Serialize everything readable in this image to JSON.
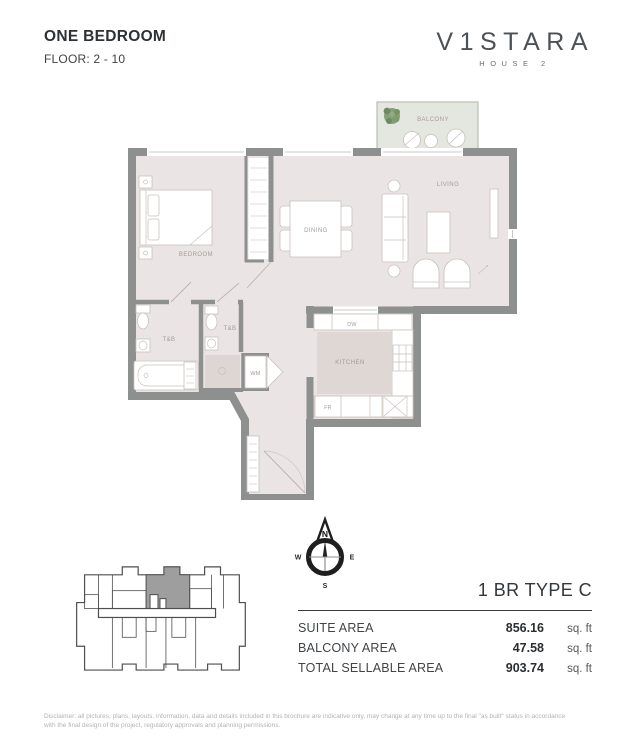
{
  "page": {
    "title": "ONE BEDROOM",
    "subtitle": "FLOOR: 2 - 10"
  },
  "logo": {
    "brand": "V1STARA",
    "sub_brand": "HOUSE 2"
  },
  "floorplan": {
    "labels": {
      "balcony": "BALCONY",
      "living": "LIVING",
      "dining": "DINING",
      "bedroom": "BEDROOM",
      "kitchen": "KITCHEN",
      "bath_main": "T&B",
      "bath_second": "T&B",
      "washer": "WM",
      "dishwasher": "DW",
      "fridge": "FR"
    }
  },
  "compass": {
    "north": "N",
    "east": "E",
    "south": "S",
    "west": "W"
  },
  "unit": {
    "type_label": "1 BR TYPE C"
  },
  "areas": {
    "rows": [
      {
        "label": "SUITE AREA",
        "value": "856.16",
        "unit": "sq. ft"
      },
      {
        "label": "BALCONY AREA",
        "value": "47.58",
        "unit": "sq. ft"
      },
      {
        "label": "TOTAL SELLABLE AREA",
        "value": "903.74",
        "unit": "sq. ft"
      }
    ]
  },
  "disclaimer": {
    "line1": "Disclaimer: all pictures, plans, layouts, information, data and details included in this brochure are indicative only, may change at any time up to the final \"as built\" status in accordance",
    "line2": "with the final design of the project, regulatory approvals and planning permissions."
  },
  "colors": {
    "wall": "#8e9090",
    "floor": "#eae5e4",
    "balcony_floor": "#e4e7df",
    "kitchen_floor": "#ded7d4",
    "shower_floor": "#ded6d3",
    "furniture_line": "#c9c1bd",
    "room_label": "#a59a97",
    "plant_green": "#7f9a72",
    "ink": "#2d3134",
    "logo_gray": "#4c5155",
    "disclaimer_gray": "#b4b2b2",
    "keyplan_line": "#4e4e4e",
    "keyplan_unit_fill": "#9e9e9e"
  }
}
